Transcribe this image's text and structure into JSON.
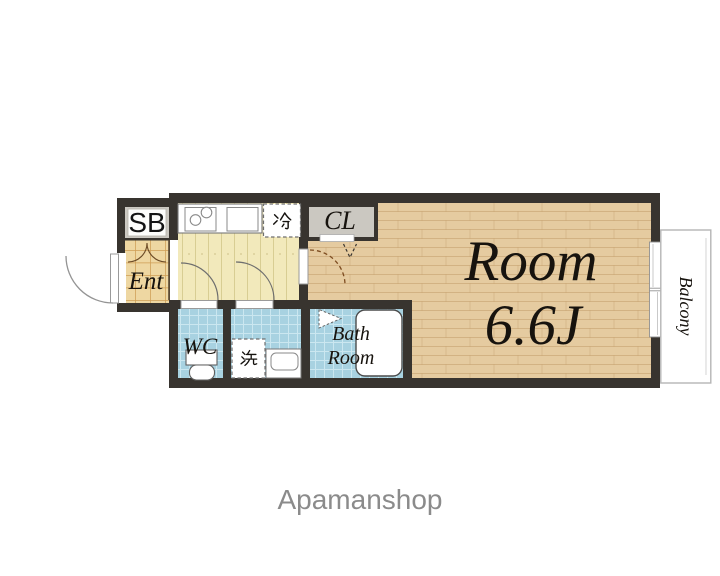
{
  "floorplan": {
    "shoe_box_label": "SB",
    "entrance_label": "Ent",
    "refrigerator_label": "冷",
    "closet_label": "CL",
    "main_room": {
      "name": "Room",
      "size": "6.6J"
    },
    "balcony_label": "Balcony",
    "wc_label": "WC",
    "washing_machine_label": "洗",
    "bath_room": {
      "line1": "Bath",
      "line2": "Room"
    }
  },
  "watermark": "Apamanshop",
  "colors": {
    "wall": "#38342f",
    "room_floor": "#e5cba0",
    "kitchen_floor": "#f2e9bb",
    "entrance_tile": "#eed7a2",
    "wet_area_tile": "#a8d2e1",
    "closet_fill": "#cbc8c1",
    "watermark_gray": "#8b8b8b"
  }
}
